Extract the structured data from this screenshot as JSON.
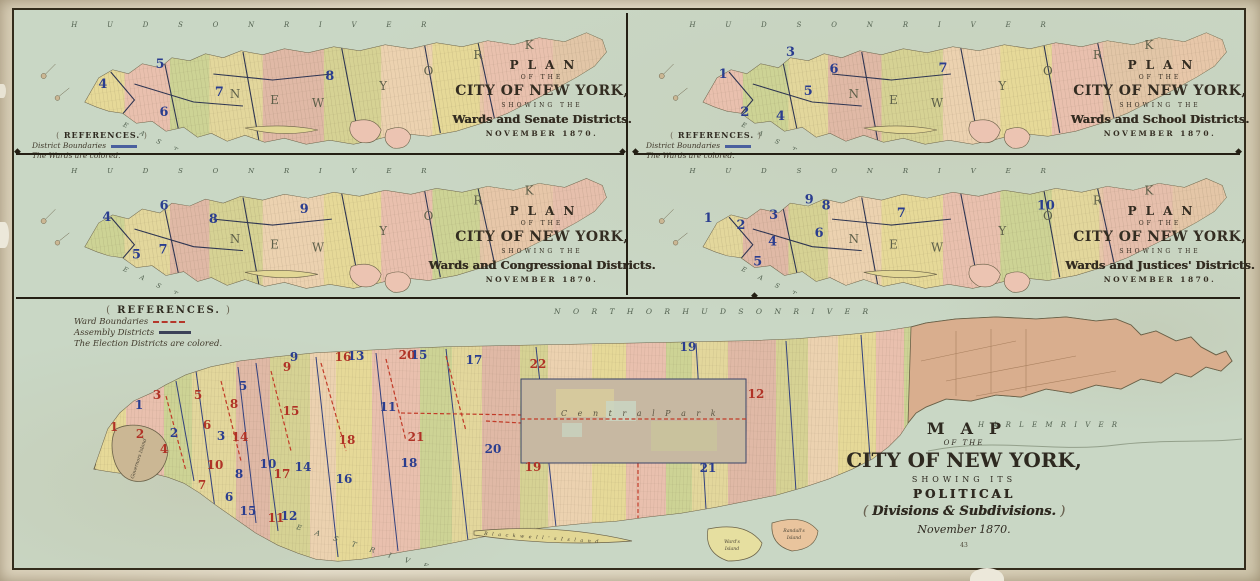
{
  "palette": {
    "water": "#c9d7c5",
    "paper": "#ded6c0",
    "frame_ink": "#332c1c",
    "title_ink": "#2e2920",
    "ward_number_red": "#b03226",
    "district_number_blue": "#2a3d8f",
    "ward_boundary_red_dashed": "#c23b28",
    "assembly_boundary_blue": "#32417e",
    "island_yellow": "#e6d998",
    "island_pink": "#e9c0ae",
    "island_green": "#cdd395",
    "upper_manhattan_brown": "#d9ae8e",
    "central_park_gray": "#c7b8a2"
  },
  "references_small": {
    "heading": "REFERENCES.",
    "boundary_label": "District Boundaries",
    "note": "The Wards are colored."
  },
  "small_maps": [
    {
      "title": {
        "line1": "PLAN",
        "line2": "OF THE",
        "line3": "CITY OF NEW YORK,",
        "line4": "SHOWING THE",
        "line5": "Wards and Senate Districts.",
        "line6": "NOVEMBER 1870."
      },
      "labels": {
        "river_top": "HUDSON RIVER",
        "river_bottom": "EAST RIVER",
        "island_name": "NEW YORK"
      },
      "numbers": [
        [
          "4",
          88,
          74
        ],
        [
          "5",
          146,
          54
        ],
        [
          "6",
          150,
          102
        ],
        [
          "7",
          206,
          82
        ],
        [
          "8",
          318,
          66
        ]
      ]
    },
    {
      "title": {
        "line1": "PLAN",
        "line2": "OF THE",
        "line3": "CITY OF NEW YORK,",
        "line4": "SHOWING THE",
        "line5": "Wards and School Districts.",
        "line6": "NOVEMBER 1870."
      },
      "labels": {
        "river_top": "HUDSON RIVER",
        "river_bottom": "EAST RIVER",
        "island_name": "NEW YORK"
      },
      "numbers": [
        [
          "1",
          90,
          64
        ],
        [
          "2",
          112,
          102
        ],
        [
          "3",
          158,
          42
        ],
        [
          "4",
          148,
          106
        ],
        [
          "5",
          176,
          81
        ],
        [
          "6",
          202,
          59
        ],
        [
          "7",
          312,
          58
        ]
      ]
    },
    {
      "title": {
        "line1": "PLAN",
        "line2": "OF THE",
        "line3": "CITY OF NEW YORK,",
        "line4": "SHOWING THE",
        "line5": "Wards and Congressional Districts.",
        "line6": "NOVEMBER 1870."
      },
      "labels": {
        "river_top": "HUDSON RIVER",
        "river_bottom": "EAST RIVER",
        "island_name": "NEW YORK"
      },
      "numbers": [
        [
          "4",
          92,
          62
        ],
        [
          "5",
          122,
          100
        ],
        [
          "6",
          150,
          50
        ],
        [
          "7",
          149,
          95
        ],
        [
          "8",
          200,
          64
        ],
        [
          "9",
          292,
          54
        ]
      ]
    },
    {
      "title": {
        "line1": "PLAN",
        "line2": "OF THE",
        "line3": "CITY OF NEW YORK,",
        "line4": "SHOWING THE",
        "line5": "Wards and Justices' Districts.",
        "line6": "NOVEMBER 1870."
      },
      "labels": {
        "river_top": "HUDSON RIVER",
        "river_bottom": "EAST RIVER",
        "island_name": "NEW YORK"
      },
      "numbers": [
        [
          "1",
          75,
          63
        ],
        [
          "2",
          108,
          70
        ],
        [
          "3",
          141,
          60
        ],
        [
          "4",
          140,
          87
        ],
        [
          "5",
          125,
          107
        ],
        [
          "6",
          187,
          78
        ],
        [
          "7",
          270,
          58
        ],
        [
          "8",
          194,
          50
        ],
        [
          "9",
          177,
          44
        ],
        [
          "10",
          416,
          50
        ]
      ]
    }
  ],
  "large_map": {
    "title": {
      "line1": "MAP",
      "line2": "OF THE",
      "line3": "CITY OF NEW YORK,",
      "line4": "SHOWING ITS",
      "line5": "POLITICAL",
      "line6": "Divisions & Subdivisions.",
      "line7": "November 1870.",
      "plate": "43"
    },
    "references": {
      "heading": "REFERENCES.",
      "item1": "Ward Boundaries",
      "item2": "Assembly Districts",
      "note": "The Election Districts are colored."
    },
    "labels": {
      "river_top": "NORTH OR HUDSON RIVER",
      "river_right": "HARLEM RIVER",
      "river_bottom": "EAST RIVER",
      "park": "Central Park",
      "governors_island": "Governors Island",
      "blackwells_island": "Blackwell's Island",
      "wards_island": "Ward's Island",
      "randalls_island": "Randall's Island"
    },
    "ward_numbers": [
      [
        "1",
        98,
        130
      ],
      [
        "2",
        124,
        137
      ],
      [
        "3",
        141,
        98
      ],
      [
        "4",
        148,
        152
      ],
      [
        "5",
        182,
        98
      ],
      [
        "6",
        191,
        128
      ],
      [
        "7",
        186,
        188
      ],
      [
        "8",
        218,
        107
      ],
      [
        "9",
        271,
        70
      ],
      [
        "10",
        199,
        168
      ],
      [
        "11",
        260,
        221
      ],
      [
        "12",
        740,
        97
      ],
      [
        "14",
        224,
        140
      ],
      [
        "15",
        275,
        114
      ],
      [
        "16",
        327,
        60
      ],
      [
        "17",
        266,
        177
      ],
      [
        "18",
        331,
        143
      ],
      [
        "19",
        517,
        170
      ],
      [
        "20",
        391,
        58
      ],
      [
        "21",
        400,
        140
      ],
      [
        "22",
        522,
        67
      ]
    ],
    "district_numbers": [
      [
        "1",
        123,
        108
      ],
      [
        "2",
        158,
        136
      ],
      [
        "3",
        205,
        139
      ],
      [
        "5",
        227,
        89
      ],
      [
        "6",
        213,
        200
      ],
      [
        "8",
        223,
        177
      ],
      [
        "9",
        278,
        60
      ],
      [
        "10",
        252,
        167
      ],
      [
        "11",
        372,
        110
      ],
      [
        "12",
        273,
        219
      ],
      [
        "13",
        340,
        59
      ],
      [
        "14",
        287,
        170
      ],
      [
        "15",
        403,
        58
      ],
      [
        "15",
        232,
        214
      ],
      [
        "16",
        328,
        182
      ],
      [
        "17",
        458,
        63
      ],
      [
        "18",
        393,
        166
      ],
      [
        "19",
        672,
        50
      ],
      [
        "20",
        477,
        152
      ],
      [
        "21",
        692,
        171
      ]
    ]
  }
}
